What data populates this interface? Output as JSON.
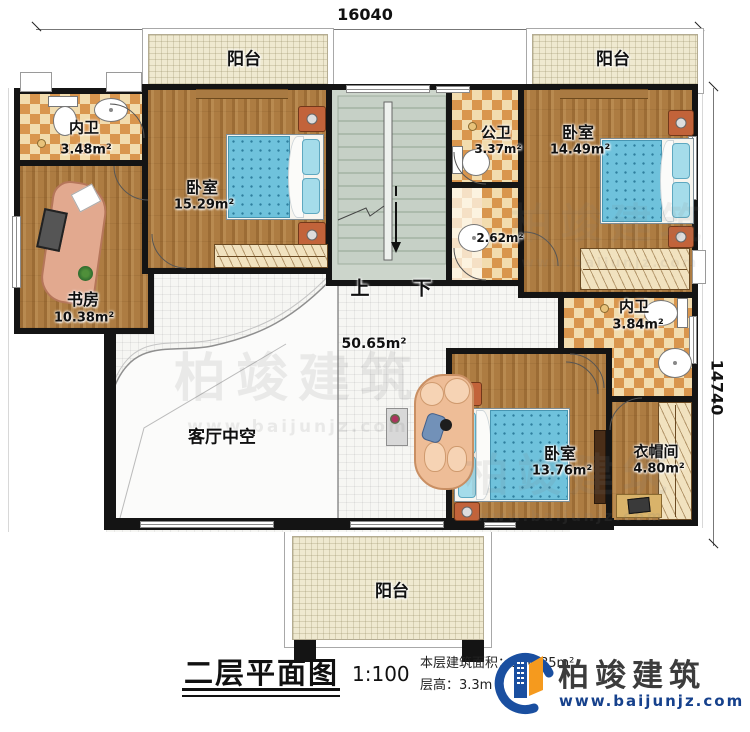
{
  "dimensions": {
    "top": "16040",
    "right": "14740"
  },
  "rooms": {
    "balcony_top_left": {
      "name": "阳台"
    },
    "balcony_top_right": {
      "name": "阳台"
    },
    "balcony_bottom": {
      "name": "阳台"
    },
    "bath_top_left": {
      "name": "内卫",
      "area": "3.48m²"
    },
    "bedroom_top_left": {
      "name": "卧室",
      "area": "15.29m²"
    },
    "study": {
      "name": "书房",
      "area": "10.38m²"
    },
    "bath_public": {
      "name": "公卫",
      "area": "3.37m²"
    },
    "vanity": {
      "area": "2.62m²"
    },
    "bedroom_top_right": {
      "name": "卧室",
      "area": "14.49m²"
    },
    "bath_right": {
      "name": "内卫",
      "area": "3.84m²"
    },
    "closet": {
      "name": "衣帽间",
      "area": "4.80m²"
    },
    "bedroom_bottom": {
      "name": "卧室",
      "area": "13.76m²"
    },
    "hall": {
      "area": "50.65m²"
    },
    "living_void": {
      "name": "客厅中空"
    },
    "stairs": {
      "up": "上",
      "down": "下"
    }
  },
  "title_block": {
    "title": "二层平面图",
    "scale": "1:100",
    "area_line": "本层建筑面积：160.85m²",
    "height_line": "层高：3.3m"
  },
  "logo": {
    "name": "柏竣建筑",
    "url": "www.baijunjz.com"
  },
  "watermark": {
    "name": "柏竣建筑",
    "url": "www.baijunjz.com"
  },
  "colors": {
    "wall": "#141414",
    "wood": "#ad7c42",
    "checker_dark": "#d9964e",
    "checker_light": "#f2dcae",
    "balcony": "#efe9d0",
    "stair": "#ccd5cb",
    "bed": "#6fc2dc",
    "logo_blue": "#1a4fa0",
    "logo_orange": "#f59a1e"
  }
}
